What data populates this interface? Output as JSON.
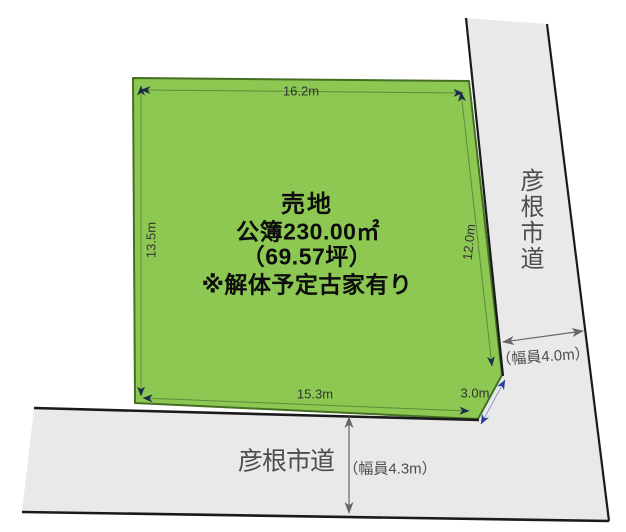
{
  "diagram": {
    "plot": {
      "label": "売地",
      "registered_area": "公簿230.00㎡",
      "tsubo": "（69.57坪）",
      "note": "※解体予定古家有り",
      "dimensions": {
        "top": "16.2m",
        "left": "13.5m",
        "right": "12.0m",
        "bottom": "15.3m",
        "corner_cut": "3.0m"
      }
    },
    "roads": {
      "right": {
        "name": "彦根市道",
        "width": "（幅員4.0m）"
      },
      "bottom": {
        "name": "彦根市道",
        "width": "（幅員4.3m）"
      }
    },
    "colors": {
      "plot_fill": "#8dc853",
      "plot_border": "#456f22",
      "road_fill": "#e9e9e9",
      "road_edge": "#1a1a1a",
      "dim_line": "#5f8c3a",
      "dim_text": "#333333",
      "road_text": "#4d4d4d",
      "arrow_dark": "#1c2b4a",
      "arrow_blue": "#2b3f9e",
      "arrow_gray": "#666666"
    }
  }
}
